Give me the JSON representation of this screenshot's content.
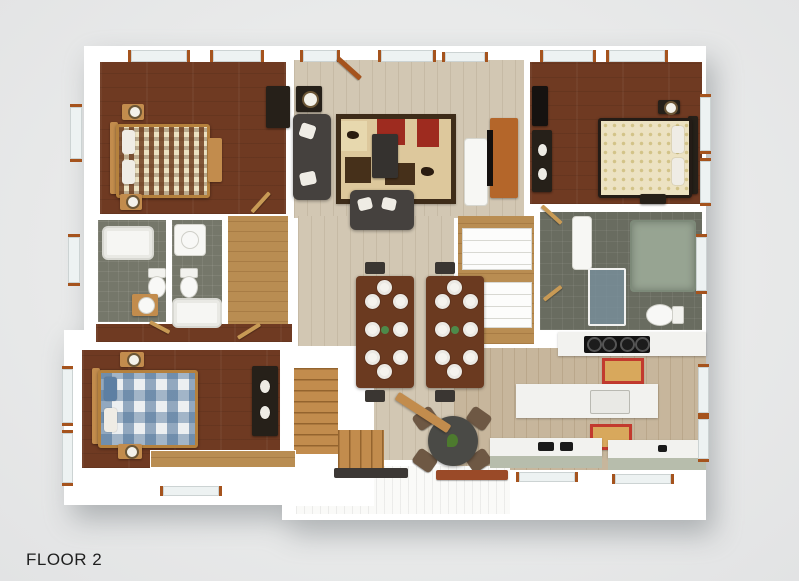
{
  "label": {
    "floor": "FLOOR 2"
  },
  "scene": {
    "kind": "top-down 3D architectural floor plan rendering",
    "rooms": [
      "bedroom top-left (dark wood floor, patterned bed)",
      "living room top-center (gray sectional, loveseat, patterned lodge rug, coffee table, TV console)",
      "bedroom top-right (cream bed against right wall)",
      "bathroom left (tub, toilet, round sink vanity)",
      "bathroom center-left (vanity, toilet, tub)",
      "walk-in closet center-right (white shelving)",
      "master bathroom right (green soaking tub, glass shower, toilet)",
      "bedroom bottom-left (blue plaid bed)",
      "dining area center (two tables with eight white place settings each)",
      "staircase bottom-center (L-shaped wood stairs)",
      "kitchen bottom-right (island with sink, cooktop, counters, two red-bordered rugs)",
      "porch bottom-center (white deck, bench)"
    ]
  },
  "palette": {
    "background": "#e9eaea",
    "wall": "#ffffff",
    "bedroom_floor": "#6f3a22",
    "living_floor": "#d2c7b3",
    "kitchen_floor": "#c7b69c",
    "hall_floor": "#b98d52",
    "tile_floor": "#75776a",
    "tile_dark": "#696c60",
    "stair_wood": "#c28c4d",
    "trim": "#a5531d",
    "sofa_dark": "#45413e",
    "rug_cream": "#ddc89c",
    "rug_red": "#9e2b1f",
    "rug_border": "#3e2c19",
    "table_wood": "#6b3a20",
    "plate": "#f5f3ee",
    "bed_cream": "#ece2c2",
    "bed_blue": "#5d7fa3",
    "tub_green": "#97a492",
    "shower_glass": "rgba(122,146,160,.75)",
    "counter_white": "#f2f2ef",
    "counter_sage": "#b7bdac",
    "small_rug_red": "#c23a2e",
    "small_rug_tan": "#d8a85c",
    "dark_furniture": "#262019",
    "deck_white": "#fafaf8",
    "text": "#1f1f1f"
  }
}
